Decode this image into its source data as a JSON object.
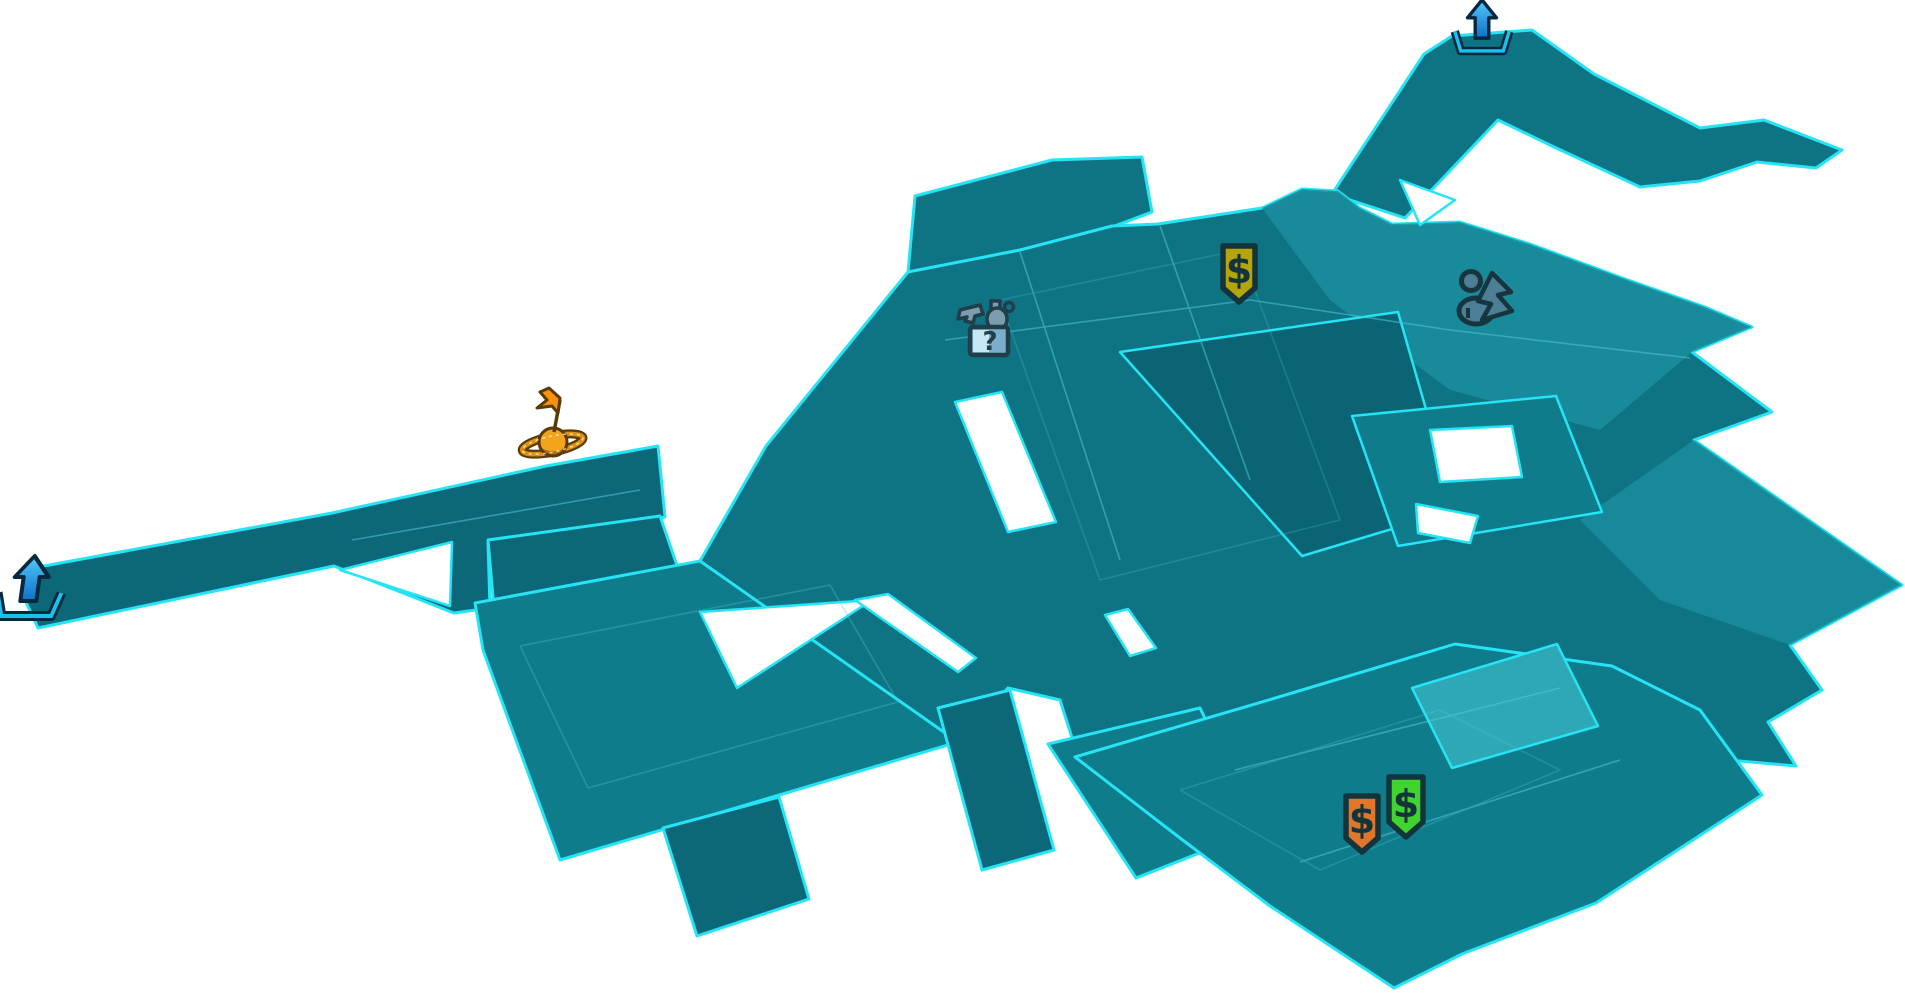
{
  "map": {
    "palette": {
      "background": "#ffffff",
      "terrain_dark": "#0C6878",
      "terrain_mid": "#0E7484",
      "terrain_mid2": "#0F7C8C",
      "terrain_light": "#1A8E9D",
      "terrain_lighter": "#2FA8B6",
      "terrain_court": "#0B6474",
      "edge": "#24E4F6",
      "seam": "#4FC6D6"
    }
  },
  "icons": {
    "exit_top": {
      "transform": "translate(1482,28) scale(0.85)",
      "arrow_top": "#54C9FB",
      "arrow_bottom": "#0B70C8",
      "bracket": "#19C2EE",
      "outline": "#06283E"
    },
    "exit_left": {
      "transform": "translate(30,589) skewX(-8)",
      "bracket": "#19C2EE",
      "outline": "#06283E"
    },
    "waypoint": {
      "transform": "translate(553,446)",
      "flag": "#F6920B",
      "sphere": "#F2A41D",
      "ring": "#DD920C",
      "outline": "#5A3A08"
    },
    "vendor_yellow": {
      "label": "$",
      "transform": "translate(1239,273)",
      "color": "#B5A40A",
      "outline": "#14343C"
    },
    "vendor_orange": {
      "label": "$",
      "transform": "translate(1362,823)",
      "color": "#E0762B",
      "outline": "#14343C"
    },
    "vendor_green": {
      "label": "$",
      "transform": "translate(1406,806)",
      "color": "#41D32E",
      "outline": "#14343C"
    },
    "fast_travel": {
      "transform": "translate(1480,305)",
      "color": "#4C7E95",
      "outline": "#16353F"
    },
    "mission_box": {
      "label": "?",
      "transform": "translate(988,331)",
      "box": "#7BAECB",
      "box_light": "#C6E6F4",
      "item": "#7C9DAE",
      "outline": "#223E49"
    }
  }
}
